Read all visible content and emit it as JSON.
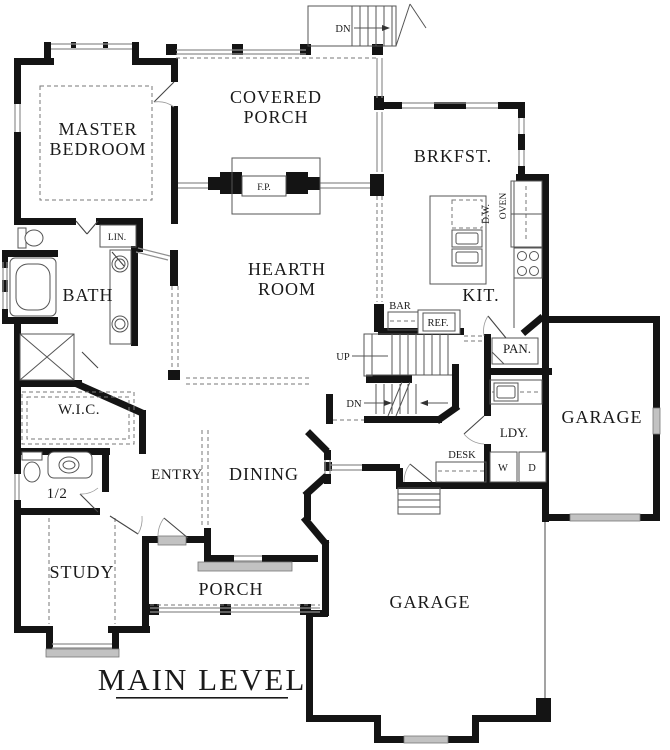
{
  "sheet": {
    "title": "MAIN LEVEL"
  },
  "rooms": {
    "master_bedroom": [
      "MASTER",
      "BEDROOM"
    ],
    "covered_porch": [
      "COVERED",
      "PORCH"
    ],
    "hearth_room": [
      "HEARTH",
      "ROOM"
    ],
    "breakfast": "BRKFST.",
    "kitchen": "KIT.",
    "bath": "BATH",
    "walk_in_closet": "W.I.C.",
    "half_bath": "1/2",
    "entry": "ENTRY",
    "dining": "DINING",
    "study": "STUDY",
    "porch": "PORCH",
    "garage_main": "GARAGE",
    "garage_single": "GARAGE",
    "laundry": "LDY.",
    "pantry": "PAN."
  },
  "annotations": {
    "linen": "LIN.",
    "fireplace": "F.P.",
    "bar": "BAR",
    "refrigerator": "REF.",
    "dishwasher": "D.W.",
    "oven": "OVEN",
    "stairs_up": "UP",
    "stairs_down": "DN",
    "porch_stairs_down": "DN",
    "desk": "DESK",
    "washer": "W",
    "dryer": "D"
  },
  "colors": {
    "wall": "#141414",
    "paper": "#ffffff",
    "window": "#8f8f8f",
    "door_panel": "#c2c2c2",
    "dash": "#777777",
    "text": "#1a1a1a"
  }
}
